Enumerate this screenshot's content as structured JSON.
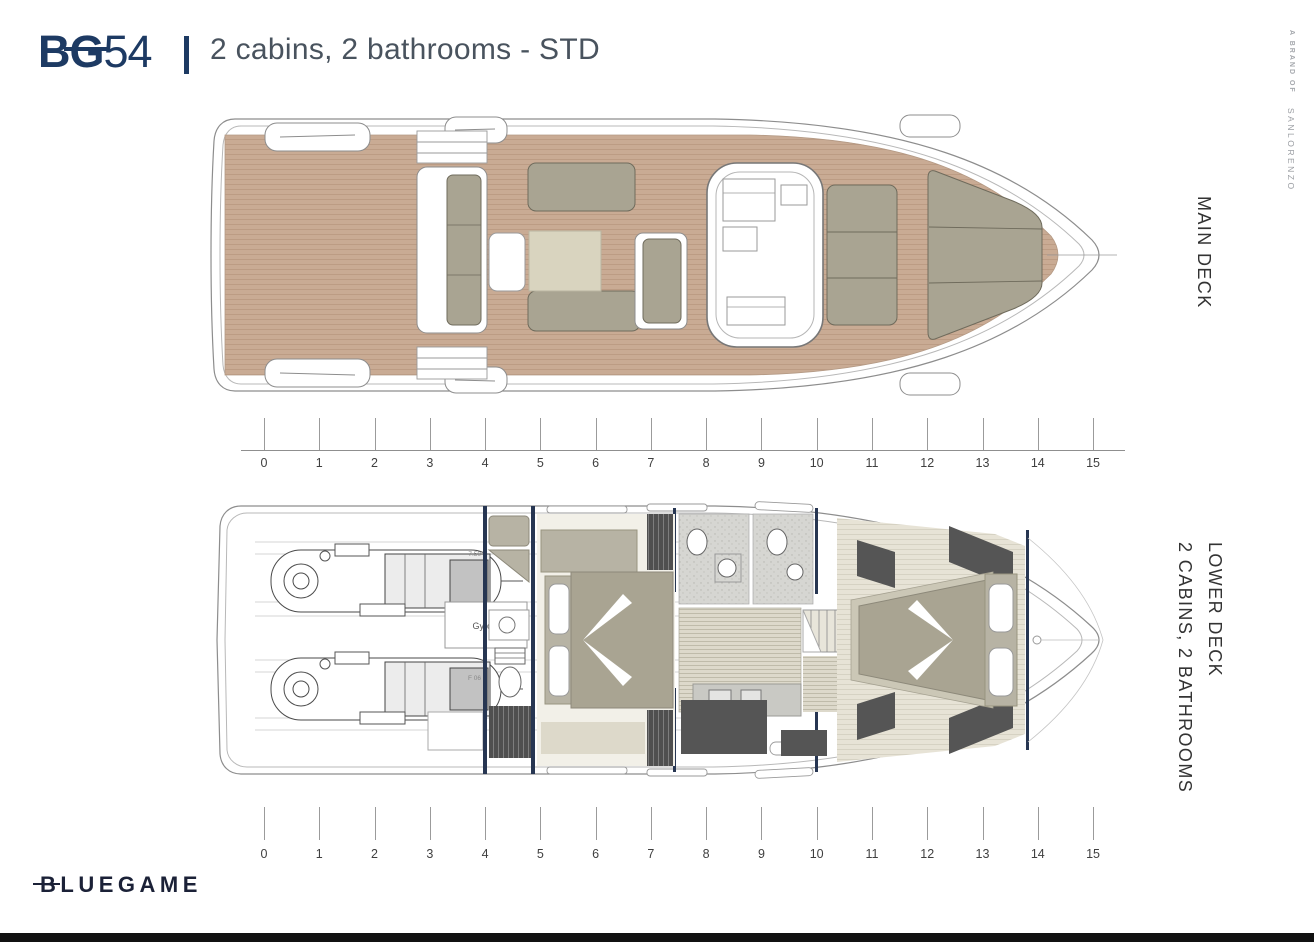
{
  "header": {
    "logo_bold": "BG",
    "logo_number": "54",
    "subtitle": "2 cabins, 2 bathrooms - STD"
  },
  "brand_mark": {
    "line1": "A BRAND OF",
    "line2": "SANLORENZO"
  },
  "deck_labels": {
    "main": "MAIN DECK",
    "lower_line1": "LOWER DECK",
    "lower_line2": "2 CABINS, 2 BATHROOMS"
  },
  "drawing_annotations": {
    "gyro": "Gyro 8",
    "dim_fwd": "7.50",
    "dim_aft": "F 06"
  },
  "rulers": {
    "main_deck_ticks": [
      "0",
      "1",
      "2",
      "3",
      "4",
      "5",
      "6",
      "7",
      "8",
      "9",
      "10",
      "11",
      "12",
      "13",
      "14",
      "15"
    ],
    "lower_deck_ticks": [
      "0",
      "1",
      "2",
      "3",
      "4",
      "5",
      "6",
      "7",
      "8",
      "9",
      "10",
      "11",
      "12",
      "13",
      "14",
      "15"
    ]
  },
  "footer": {
    "logo": "BLUEGAME"
  },
  "colors": {
    "navy": "#1d3a63",
    "logo_navy": "#1b2137",
    "subtitle_gray": "#49535e",
    "deck_wood": "#c9ab94",
    "cushion_olive": "#a9a492",
    "table_beige": "#d9d4bf",
    "taupe": "#b7b3a4",
    "pale_floor": "#f2f0e8",
    "dark_furniture": "#555555",
    "bulkhead_navy": "#273652",
    "label_gray": "#a5a8ad",
    "deck_label_color": "#333333",
    "ruler_color": "#8f8f8f",
    "bottom_bar": "#111111"
  }
}
